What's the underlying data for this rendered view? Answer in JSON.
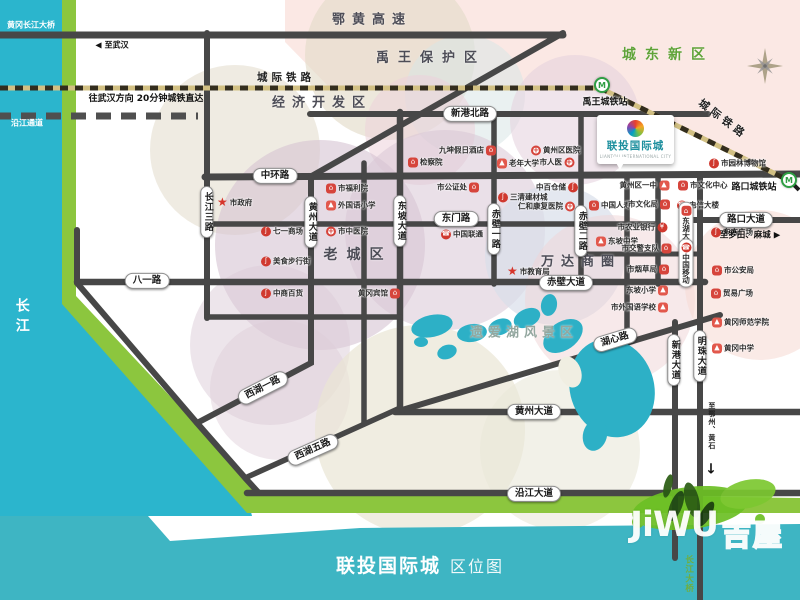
{
  "colors": {
    "river": "#2bb5cd",
    "shore_band": "#8cc63e",
    "bottom_bar": "#3eb5c3",
    "road": "#474747",
    "railway_dark": "#332d1d",
    "railway_light": "#d2c083",
    "lake": "#2db0c6",
    "metro_green": "#2f9e44",
    "brand_teal": "#1d8f9e",
    "zone_green": "#5fa338",
    "poi_red": "#d6453c"
  },
  "title_bar": {
    "project": "联投国际城",
    "doc": "区位图"
  },
  "watermark": {
    "latin": "JiWU",
    "cjk": "吉屋"
  },
  "project_callout": {
    "name": "联投国际城",
    "tagline": "LIANTOU INTERNATIONAL CITY"
  },
  "zone_labels": [
    {
      "label": "鄂黄高速",
      "x": 372,
      "y": 18,
      "fs": 13,
      "ls": 7,
      "color": "#4d4d57"
    },
    {
      "label": "禹王保护区",
      "x": 431,
      "y": 56,
      "fs": 13,
      "ls": 9,
      "color": "#4d4d57"
    },
    {
      "label": "经济开发区",
      "x": 322,
      "y": 101,
      "fs": 13,
      "ls": 7,
      "color": "#4d4d57"
    },
    {
      "label": "城东新区",
      "x": 668,
      "y": 54,
      "fs": 14,
      "ls": 9,
      "color": "#5fa338"
    },
    {
      "label": "老城区",
      "x": 358,
      "y": 254,
      "fs": 14,
      "ls": 9,
      "color": "#4d4d57"
    },
    {
      "label": "万达商圈",
      "x": 581,
      "y": 260,
      "fs": 13,
      "ls": 7,
      "color": "#4d4d57"
    },
    {
      "label": "遗爱湖风景区",
      "x": 524,
      "y": 331,
      "fs": 13,
      "ls": 5,
      "color": "#93a79f"
    }
  ],
  "rail_labels": [
    {
      "label": "城际铁路",
      "x": 286,
      "y": 77,
      "rot": 0
    },
    {
      "label": "城际铁路",
      "x": 723,
      "y": 119,
      "rot": 37
    }
  ],
  "road_labels": [
    {
      "label": "中环路",
      "x": 275,
      "y": 176,
      "o": "h"
    },
    {
      "label": "新港北路",
      "x": 470,
      "y": 114,
      "o": "h"
    },
    {
      "label": "东门路",
      "x": 456,
      "y": 219,
      "o": "h"
    },
    {
      "label": "八一路",
      "x": 147,
      "y": 281,
      "o": "h"
    },
    {
      "label": "赤壁大道",
      "x": 566,
      "y": 283,
      "o": "h"
    },
    {
      "label": "黄州大道",
      "x": 534,
      "y": 412,
      "o": "h"
    },
    {
      "label": "沿江大道",
      "x": 534,
      "y": 494,
      "o": "h"
    },
    {
      "label": "路口大道",
      "x": 746,
      "y": 220,
      "o": "h"
    },
    {
      "label": "长江三路",
      "x": 207,
      "y": 212,
      "o": "v"
    },
    {
      "label": "黄州大道",
      "x": 311,
      "y": 222,
      "o": "v"
    },
    {
      "label": "东坡大道",
      "x": 400,
      "y": 221,
      "o": "v"
    },
    {
      "label": "赤壁一路",
      "x": 494,
      "y": 229,
      "o": "v"
    },
    {
      "label": "赤壁二路",
      "x": 581,
      "y": 231,
      "o": "v"
    },
    {
      "label": "新港大道",
      "x": 674,
      "y": 360,
      "o": "v"
    },
    {
      "label": "明珠大道",
      "x": 700,
      "y": 356,
      "o": "v"
    },
    {
      "label": "西湖一路",
      "x": 263,
      "y": 388,
      "o": "r",
      "rot": -27
    },
    {
      "label": "西湖五路",
      "x": 313,
      "y": 450,
      "o": "r",
      "rot": -24
    },
    {
      "label": "湖心路",
      "x": 615,
      "y": 340,
      "o": "r",
      "rot": -17
    }
  ],
  "stations": [
    {
      "label": "禹王城铁站",
      "ix": 602,
      "iy": 85,
      "lx": 605,
      "ly": 101
    },
    {
      "label": "路口城铁站",
      "ix": 789,
      "iy": 180,
      "lx": 754,
      "ly": 186
    }
  ],
  "metro_glyph": "M",
  "notes": [
    {
      "id": "bridge-northwest",
      "text": "黄冈长江大桥",
      "x": 31,
      "y": 26,
      "fs": 8,
      "color": "#ffffff"
    },
    {
      "id": "riverside-tunnel",
      "text": "沿江通道",
      "x": 27,
      "y": 124,
      "fs": 8,
      "color": "#ffffff"
    },
    {
      "id": "to-wuhan",
      "text": "至武汉",
      "x": 112,
      "y": 46,
      "fs": 8,
      "color": "#111111",
      "pre": "◀"
    },
    {
      "id": "rail-note",
      "text": "往武汉方向  20分钟城铁直达",
      "x": 146,
      "y": 100,
      "fs": 9,
      "color": "#111111"
    },
    {
      "id": "to-luotian-macheng",
      "text": "至罗田、麻城",
      "x": 750,
      "y": 236,
      "fs": 8.5,
      "color": "#111111",
      "post": "▶"
    },
    {
      "id": "yangtze-river",
      "text": "长江",
      "x": 21,
      "y": 318,
      "fs": 14,
      "color": "#ffffff",
      "vertical": true,
      "ls": 6
    },
    {
      "id": "to-ezhou-huangshi",
      "text": "至鄂州、黄石",
      "x": 711,
      "y": 426,
      "fs": 7,
      "color": "#222222",
      "vertical": true,
      "ls": 1
    },
    {
      "id": "south-arrow",
      "text": "↓",
      "x": 711,
      "y": 470,
      "fs": 14,
      "color": "#111111"
    },
    {
      "id": "bridge-south",
      "text": "长江大桥",
      "x": 688,
      "y": 574,
      "fs": 8.5,
      "color": "#6fae3f",
      "vertical": true,
      "ls": 1
    }
  ],
  "icon_glyphs": {
    "star": "★",
    "mall": "ʃ",
    "building": "⌂",
    "school": "▲",
    "cross": "+",
    "telecom": "☎",
    "bank": "¥"
  },
  "pois": [
    {
      "name": "市政府",
      "x": 222,
      "y": 202,
      "icon": "star",
      "side": "L"
    },
    {
      "name": "七一商场",
      "x": 266,
      "y": 231,
      "icon": "mall",
      "side": "L"
    },
    {
      "name": "美食步行街",
      "x": 266,
      "y": 261,
      "icon": "mall",
      "side": "L"
    },
    {
      "name": "中商百货",
      "x": 266,
      "y": 293,
      "icon": "mall",
      "side": "L"
    },
    {
      "name": "黄冈宾馆",
      "x": 394,
      "y": 293,
      "icon": "building",
      "side": "R"
    },
    {
      "name": "市福利院",
      "x": 331,
      "y": 188,
      "icon": "building",
      "side": "L"
    },
    {
      "name": "外国语小学",
      "x": 331,
      "y": 205,
      "icon": "school",
      "side": "L"
    },
    {
      "name": "市中医院",
      "x": 331,
      "y": 231,
      "icon": "cross",
      "side": "L"
    },
    {
      "name": "检察院",
      "x": 413,
      "y": 162,
      "icon": "building",
      "side": "L"
    },
    {
      "name": "九坤假日酒店",
      "x": 490,
      "y": 150,
      "icon": "building",
      "side": "R"
    },
    {
      "name": "老年大学",
      "x": 502,
      "y": 163,
      "icon": "school",
      "side": "L"
    },
    {
      "name": "黄州区医院",
      "x": 536,
      "y": 150,
      "icon": "cross",
      "side": "L"
    },
    {
      "name": "市人医",
      "x": 568,
      "y": 162,
      "icon": "cross",
      "side": "R"
    },
    {
      "name": "市公证处",
      "x": 473,
      "y": 187,
      "icon": "building",
      "side": "R"
    },
    {
      "name": "三清建材城",
      "x": 503,
      "y": 197,
      "icon": "mall",
      "side": "L"
    },
    {
      "name": "中百仓储",
      "x": 572,
      "y": 187,
      "icon": "mall",
      "side": "R"
    },
    {
      "name": "仁和康复医院",
      "x": 569,
      "y": 206,
      "icon": "cross",
      "side": "R"
    },
    {
      "name": "中国联通",
      "x": 446,
      "y": 234,
      "icon": "telecom",
      "side": "L"
    },
    {
      "name": "市教育局",
      "x": 512,
      "y": 271,
      "icon": "star",
      "side": "L"
    },
    {
      "name": "中国人寿",
      "x": 594,
      "y": 205,
      "icon": "building",
      "side": "L"
    },
    {
      "name": "市文化局",
      "x": 664,
      "y": 204,
      "icon": "building",
      "side": "R"
    },
    {
      "name": "黄州区一中",
      "x": 663,
      "y": 185,
      "icon": "school",
      "side": "R"
    },
    {
      "name": "市文化中心",
      "x": 683,
      "y": 185,
      "icon": "building",
      "side": "L"
    },
    {
      "name": "电信大楼",
      "x": 682,
      "y": 205,
      "icon": "telecom",
      "side": "L"
    },
    {
      "name": "市园林博物馆",
      "x": 714,
      "y": 163,
      "icon": "mall",
      "side": "L"
    },
    {
      "name": "市农业银行",
      "x": 661,
      "y": 227,
      "icon": "bank",
      "side": "R"
    },
    {
      "name": "东坡中学",
      "x": 601,
      "y": 241,
      "icon": "school",
      "side": "L"
    },
    {
      "name": "市交警支队",
      "x": 665,
      "y": 248,
      "icon": "building",
      "side": "R"
    },
    {
      "name": "市烟草局",
      "x": 663,
      "y": 269,
      "icon": "building",
      "side": "R"
    },
    {
      "name": "东方广场",
      "x": 716,
      "y": 232,
      "icon": "mall",
      "side": "L"
    },
    {
      "name": "市公安局",
      "x": 717,
      "y": 270,
      "icon": "building",
      "side": "L"
    },
    {
      "name": "贸易广场",
      "x": 716,
      "y": 293,
      "icon": "building",
      "side": "L"
    },
    {
      "name": "东坡小学",
      "x": 662,
      "y": 290,
      "icon": "school",
      "side": "R"
    },
    {
      "name": "市外国语学校",
      "x": 662,
      "y": 307,
      "icon": "school",
      "side": "R"
    },
    {
      "name": "黄冈师范学院",
      "x": 717,
      "y": 322,
      "icon": "school",
      "side": "L"
    },
    {
      "name": "黄冈中学",
      "x": 717,
      "y": 348,
      "icon": "school",
      "side": "L"
    },
    {
      "name": "东湖大酒店",
      "x": 686,
      "y": 230,
      "icon": "building",
      "vpill": true
    },
    {
      "name": "中国移动",
      "x": 686,
      "y": 263,
      "icon": "telecom",
      "vpill": true
    }
  ]
}
